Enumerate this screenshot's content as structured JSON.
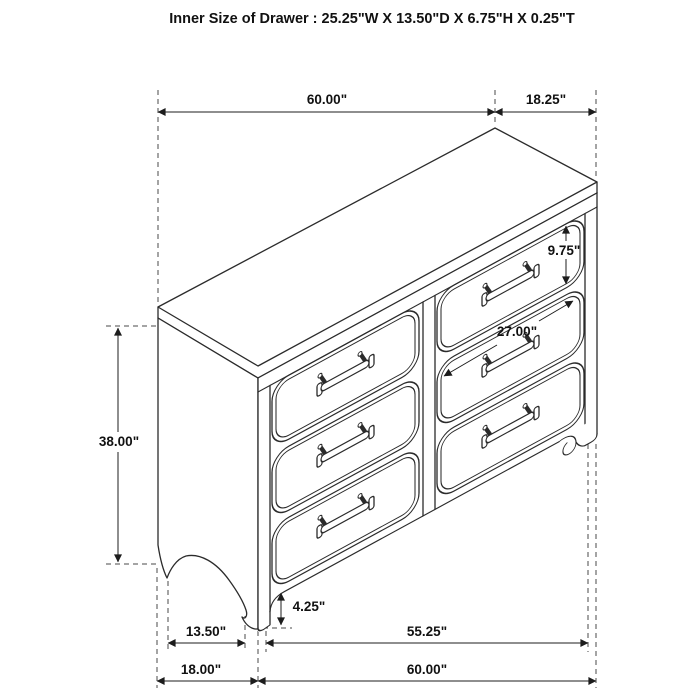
{
  "title": "Inner Size of Drawer : 25.25\"W X 13.50\"D X 6.75\"H X 0.25\"T",
  "diagram": {
    "subject": "six-drawer dresser isometric line drawing with dimension callouts",
    "drawers": {
      "count": 6,
      "columns": 2,
      "rows": 3
    },
    "colors": {
      "background": "#ffffff",
      "line": "#2b2b2b",
      "dashed_guide": "#4a4a4a",
      "text": "#111111"
    },
    "dimensions": {
      "top_width": "60.00\"",
      "top_depth": "18.25\"",
      "drawer_height": "9.75\"",
      "drawer_width": "27.00\"",
      "overall_height": "38.00\"",
      "foot_clearance": "4.25\"",
      "base_side_depth": "13.50\"",
      "base_inner_width": "55.25\"",
      "base_depth": "18.00\"",
      "base_width": "60.00\""
    }
  }
}
